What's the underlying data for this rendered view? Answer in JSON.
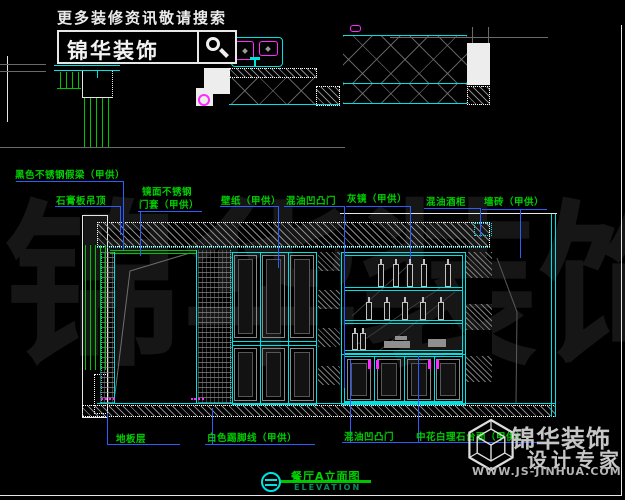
{
  "header": {
    "tagline": "更多装修资讯敬请搜索",
    "brand": "锦华装饰",
    "search_icon": "magnifier"
  },
  "watermark": {
    "characters": [
      "锦",
      "华",
      "装",
      "饰"
    ]
  },
  "callouts": {
    "top": [
      {
        "text": "黑色不锈钢假梁（甲供）"
      },
      {
        "text": "石膏板吊顶"
      },
      {
        "line1": "镜面不锈钢",
        "line2": "门套（甲供）"
      },
      {
        "text": "壁纸（甲供）"
      },
      {
        "text": "混油凹凸门"
      },
      {
        "text": "灰镜（甲供）"
      },
      {
        "text": "混油酒柜"
      },
      {
        "text": "墙砖（甲供）"
      }
    ],
    "bottom": [
      {
        "text": "地板层"
      },
      {
        "text": "白色踢脚线（甲供）"
      },
      {
        "text": "混油凹凸门"
      },
      {
        "text": "中花白理石台面（甲供）"
      }
    ]
  },
  "title_block": {
    "name": "餐厅A立面图",
    "subtitle": "ELEVATION"
  },
  "brand_footer": {
    "brand": "锦华装饰",
    "slogan": "设计专家",
    "website": "WWW.JS-JINHUA.COM",
    "logo_icon": "wireframe-cube"
  },
  "icons": {
    "search": "magnifier-icon",
    "section_mark": "section-circle-icon",
    "sink": "double-sink-icon",
    "cooktop": "burner-icon",
    "bottles": "bottle-icon"
  },
  "colors": {
    "cad_cyan": "#00e2e2",
    "cad_green": "#00c400",
    "leader_blue": "#2e5dff",
    "cad_magenta": "#ff2bff",
    "label_green": "#00cf00",
    "background": "#000000"
  }
}
